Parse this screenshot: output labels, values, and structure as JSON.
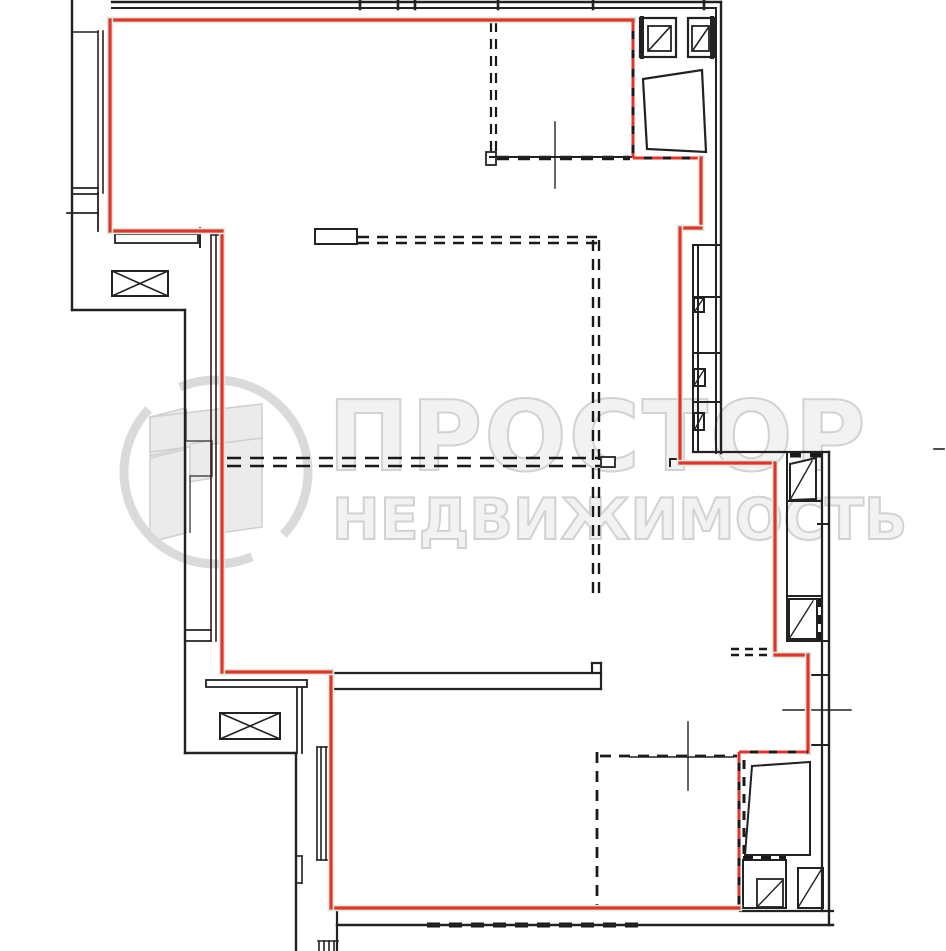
{
  "watermark": {
    "brand_line1": "ПРОСТОР",
    "brand_line2": "НЕДВИЖИМОСТЬ",
    "text_color": "#f2f2f2",
    "outline_color": "#d2d2d2",
    "logo": {
      "ring_color": "#dadada",
      "ring_width": 9,
      "ring_arcs": [
        "M180 387.3 A92 92 0 0 1 283.3 534.7",
        "M252 556.7 A92 92 0 0 1 148.7 409.3"
      ],
      "building_fill": "#ebebeb",
      "building_stroke": "#cfcfcf",
      "building_polys": [
        "150,417 186,408 186,447 150,456",
        "150,458 186,449 186,533 150,542",
        "220,414 262,419 262,527 220,533",
        "150,417 262,404 262,438 150,452",
        "190,444 212,440 212,478 190,482"
      ],
      "notch_outline": "186,410 186,441 212,441 212,476 190,476 190,533",
      "notch_color": "#4a4a4a"
    }
  },
  "plan": {
    "canvas": {
      "width": 946,
      "height": 951
    },
    "colors": {
      "wall": "#222222",
      "dash": "#1a1a1a",
      "red": "#e63228",
      "red_halo": "#d6ecdf",
      "white": "#ffffff"
    },
    "red_boundary_segments": [
      {
        "x1": 110,
        "y1": 20,
        "x2": 633,
        "y2": 20,
        "style": "solid"
      },
      {
        "x1": 633,
        "y1": 20,
        "x2": 633,
        "y2": 158,
        "style": "open"
      },
      {
        "x1": 633,
        "y1": 158,
        "x2": 701,
        "y2": 158,
        "style": "open"
      },
      {
        "x1": 701,
        "y1": 158,
        "x2": 701,
        "y2": 228,
        "style": "solid"
      },
      {
        "x1": 680,
        "y1": 228,
        "x2": 701,
        "y2": 228,
        "style": "solid"
      },
      {
        "x1": 680,
        "y1": 228,
        "x2": 680,
        "y2": 463,
        "style": "solid"
      },
      {
        "x1": 680,
        "y1": 463,
        "x2": 775,
        "y2": 463,
        "style": "solid"
      },
      {
        "x1": 775,
        "y1": 463,
        "x2": 775,
        "y2": 655,
        "style": "solid"
      },
      {
        "x1": 775,
        "y1": 655,
        "x2": 808,
        "y2": 655,
        "style": "solid"
      },
      {
        "x1": 808,
        "y1": 655,
        "x2": 808,
        "y2": 752,
        "style": "solid"
      },
      {
        "x1": 739,
        "y1": 752,
        "x2": 808,
        "y2": 752,
        "style": "open"
      },
      {
        "x1": 739,
        "y1": 752,
        "x2": 739,
        "y2": 908,
        "style": "open"
      },
      {
        "x1": 331,
        "y1": 908,
        "x2": 739,
        "y2": 908,
        "style": "solid"
      },
      {
        "x1": 331,
        "y1": 672,
        "x2": 331,
        "y2": 908,
        "style": "solid"
      },
      {
        "x1": 222,
        "y1": 672,
        "x2": 331,
        "y2": 672,
        "style": "solid"
      },
      {
        "x1": 222,
        "y1": 231,
        "x2": 222,
        "y2": 672,
        "style": "solid"
      },
      {
        "x1": 110,
        "y1": 231,
        "x2": 222,
        "y2": 231,
        "style": "solid"
      },
      {
        "x1": 110,
        "y1": 20,
        "x2": 110,
        "y2": 231,
        "style": "solid"
      }
    ],
    "wall_lines": [
      [
        112,
        2,
        721,
        2,
        2.4
      ],
      [
        112,
        8,
        716,
        8,
        2
      ],
      [
        716,
        8,
        716,
        453,
        2
      ],
      [
        721,
        2,
        721,
        453,
        2.4
      ],
      [
        360,
        0,
        360,
        9,
        2.6
      ],
      [
        398,
        0,
        398,
        9,
        2.6
      ],
      [
        415,
        0,
        415,
        9,
        2.6
      ],
      [
        498,
        0,
        498,
        9,
        2.6
      ],
      [
        593,
        0,
        593,
        9,
        2.6
      ],
      [
        704,
        0,
        704,
        9,
        2.6
      ],
      [
        72,
        0,
        72,
        310,
        2.4
      ],
      [
        72,
        310,
        185,
        310,
        2.4
      ],
      [
        185,
        310,
        185,
        753,
        2.4
      ],
      [
        185,
        753,
        296,
        753,
        2.4
      ],
      [
        296,
        753,
        296,
        950,
        2.4
      ],
      [
        296,
        856,
        302,
        856,
        1.6
      ],
      [
        302,
        856,
        302,
        883,
        1.6
      ],
      [
        296,
        883,
        302,
        883,
        1.6
      ],
      [
        337,
        907,
        337,
        950,
        2.2
      ],
      [
        318,
        941,
        338,
        941,
        1.6
      ],
      [
        319,
        941,
        319,
        951,
        1.6
      ],
      [
        324,
        941,
        324,
        951,
        1.6
      ],
      [
        329,
        941,
        329,
        951,
        1.6
      ],
      [
        334,
        941,
        334,
        951,
        1.6
      ],
      [
        98,
        31,
        98,
        193,
        1.6
      ],
      [
        103,
        31,
        103,
        193,
        1.6
      ],
      [
        108,
        31,
        108,
        193,
        1.6
      ],
      [
        72,
        32,
        98,
        32,
        1.6
      ],
      [
        72,
        188,
        98,
        188,
        1.8
      ],
      [
        72,
        194,
        98,
        194,
        1.8
      ],
      [
        98,
        193,
        98,
        231,
        1.8
      ],
      [
        67,
        213,
        98,
        213,
        1.8
      ],
      [
        200,
        228,
        200,
        247,
        2
      ],
      [
        211,
        234,
        211,
        641,
        1.6
      ],
      [
        216,
        234,
        216,
        641,
        1.6
      ],
      [
        221,
        234,
        221,
        641,
        1.6
      ],
      [
        211,
        235,
        222,
        235,
        1.6
      ],
      [
        185,
        630,
        211,
        630,
        1.8
      ],
      [
        185,
        641,
        211,
        641,
        1.8
      ],
      [
        297,
        687,
        297,
        753,
        1.8
      ],
      [
        302,
        687,
        302,
        753,
        1.8
      ],
      [
        317,
        747,
        317,
        860,
        1.6
      ],
      [
        321,
        747,
        321,
        860,
        1.6
      ],
      [
        326,
        747,
        326,
        860,
        1.6
      ],
      [
        317,
        747,
        331,
        747,
        1.6
      ],
      [
        317,
        860,
        331,
        860,
        1.6
      ],
      [
        333,
        673,
        601,
        673,
        2.2
      ],
      [
        333,
        689,
        601,
        689,
        2.2
      ],
      [
        333,
        673,
        333,
        689,
        2.2
      ],
      [
        601,
        663,
        601,
        689,
        2.2
      ],
      [
        592,
        663,
        592,
        673,
        2.2
      ],
      [
        592,
        663,
        601,
        663,
        2.2
      ],
      [
        337,
        925,
        833,
        925,
        2.4
      ],
      [
        740,
        911,
        833,
        911,
        2.2
      ],
      [
        822,
        452,
        822,
        911,
        2.2
      ],
      [
        829,
        452,
        829,
        925,
        2.4
      ],
      [
        693,
        452,
        829,
        452,
        2.2
      ],
      [
        693,
        245,
        693,
        452,
        2
      ],
      [
        698,
        245,
        698,
        452,
        2
      ],
      [
        693,
        245,
        721,
        245,
        2
      ],
      [
        693,
        297,
        721,
        297,
        2
      ],
      [
        693,
        353,
        721,
        353,
        2
      ],
      [
        693,
        402,
        721,
        402,
        2
      ],
      [
        695,
        311,
        703,
        299,
        1.4
      ],
      [
        695,
        384,
        704,
        370,
        1.4
      ],
      [
        695,
        429,
        703,
        414,
        1.4
      ],
      [
        642,
        18,
        642,
        57,
        4
      ],
      [
        712,
        18,
        712,
        57,
        4
      ],
      [
        676,
        18,
        676,
        57,
        2
      ],
      [
        688,
        18,
        688,
        57,
        2
      ],
      [
        649,
        50,
        670,
        27,
        1.6
      ],
      [
        693,
        50,
        708,
        28,
        1.6
      ],
      [
        555,
        122,
        555,
        188,
        1.4
      ],
      [
        490,
        157,
        633,
        157,
        2
      ],
      [
        688,
        722,
        688,
        790,
        1.4
      ],
      [
        630,
        757,
        733,
        757,
        1.4
      ],
      [
        783,
        710,
        851,
        710,
        1.4
      ],
      [
        934,
        449,
        944,
        449,
        1.6
      ],
      [
        670,
        459,
        678,
        459,
        2
      ],
      [
        670,
        459,
        670,
        466,
        2
      ],
      [
        787,
        452,
        787,
        641,
        2
      ],
      [
        787,
        501,
        822,
        501,
        2
      ],
      [
        787,
        596,
        822,
        596,
        2
      ],
      [
        787,
        641,
        829,
        641,
        2
      ],
      [
        808,
        675,
        829,
        675,
        2
      ],
      [
        818,
        524,
        829,
        524,
        2
      ],
      [
        808,
        745,
        829,
        745,
        2
      ],
      [
        790,
        500,
        812,
        461,
        1.4
      ],
      [
        789,
        639,
        813,
        601,
        1.4
      ],
      [
        745,
        855,
        752,
        766,
        1.4
      ],
      [
        758,
        906,
        782,
        881,
        1.4
      ],
      [
        799,
        906,
        821,
        870,
        1.4
      ]
    ],
    "wall_dashes": [
      [
        491,
        22,
        491,
        152,
        2.2,
        "10 7"
      ],
      [
        496,
        22,
        496,
        152,
        2.2,
        "10 7"
      ],
      [
        497,
        158,
        630,
        158,
        4.5,
        "12 9"
      ],
      [
        358,
        237,
        598,
        237,
        2.4,
        "11 8"
      ],
      [
        358,
        243,
        598,
        243,
        2.4,
        "11 8"
      ],
      [
        227,
        458,
        600,
        458,
        2.4,
        "14 9"
      ],
      [
        227,
        466,
        600,
        466,
        2.4,
        "14 9"
      ],
      [
        593,
        240,
        593,
        601,
        2.4,
        "11 8"
      ],
      [
        599,
        240,
        599,
        601,
        2.4,
        "11 8"
      ],
      [
        597,
        752,
        597,
        907,
        2.8,
        "11 8"
      ],
      [
        600,
        756,
        737,
        756,
        2.8,
        "11 8"
      ],
      [
        790,
        455,
        825,
        455,
        5,
        "11 9"
      ],
      [
        820,
        598,
        820,
        640,
        5,
        "9 8"
      ],
      [
        743,
        858,
        786,
        858,
        4,
        "10 8"
      ],
      [
        744,
        760,
        744,
        856,
        3,
        "9 8"
      ],
      [
        731,
        649,
        772,
        649,
        2.4,
        "8 6"
      ],
      [
        731,
        655,
        772,
        655,
        2.4,
        "8 6"
      ],
      [
        427,
        925,
        643,
        925,
        5,
        "13 9"
      ]
    ],
    "wall_rects": [
      {
        "x": 115,
        "y": 234,
        "w": 83,
        "h": 9,
        "sw": 1.8,
        "fill": "none"
      },
      {
        "x": 206,
        "y": 680,
        "w": 101,
        "h": 7,
        "sw": 1.8,
        "fill": "none"
      },
      {
        "x": 315,
        "y": 229,
        "w": 42,
        "h": 15,
        "sw": 2,
        "fill": "#ffffff"
      },
      {
        "x": 486,
        "y": 152,
        "w": 10,
        "h": 13,
        "sw": 1.8,
        "fill": "#ffffff"
      },
      {
        "x": 601,
        "y": 457,
        "w": 14,
        "h": 10,
        "sw": 1.8,
        "fill": "#ffffff"
      },
      {
        "x": 640,
        "y": 18,
        "w": 36,
        "h": 39,
        "sw": 2.2,
        "fill": "#ffffff"
      },
      {
        "x": 688,
        "y": 18,
        "w": 27,
        "h": 39,
        "sw": 2.2,
        "fill": "#ffffff"
      },
      {
        "x": 648,
        "y": 26,
        "w": 23,
        "h": 25,
        "sw": 1.8,
        "fill": "none"
      },
      {
        "x": 692,
        "y": 26,
        "w": 17,
        "h": 25,
        "sw": 1.8,
        "fill": "none"
      },
      {
        "x": 694,
        "y": 298,
        "w": 10,
        "h": 14,
        "sw": 2,
        "fill": "none"
      },
      {
        "x": 694,
        "y": 369,
        "w": 11,
        "h": 17,
        "sw": 2,
        "fill": "none"
      },
      {
        "x": 694,
        "y": 413,
        "w": 10,
        "h": 17,
        "sw": 2,
        "fill": "none"
      },
      {
        "x": 789,
        "y": 599,
        "w": 28,
        "h": 40,
        "sw": 2,
        "fill": "#ffffff"
      },
      {
        "x": 743,
        "y": 860,
        "w": 43,
        "h": 48,
        "sw": 2,
        "fill": "#ffffff"
      },
      {
        "x": 757,
        "y": 879,
        "w": 26,
        "h": 28,
        "sw": 1.8,
        "fill": "none"
      },
      {
        "x": 798,
        "y": 868,
        "w": 25,
        "h": 40,
        "sw": 2,
        "fill": "#ffffff"
      }
    ],
    "door_polys": [
      {
        "pts": "643,79 702,70 706,152 647,149",
        "sw": 2.2
      },
      {
        "pts": "790,464 816,458 816,499 790,500",
        "sw": 2
      },
      {
        "pts": "752,766 810,762 810,855 745,855",
        "sw": 2
      }
    ],
    "x_boxes": [
      {
        "x": 112,
        "y": 271,
        "w": 56,
        "h": 25
      },
      {
        "x": 220,
        "y": 713,
        "w": 60,
        "h": 26
      }
    ]
  }
}
